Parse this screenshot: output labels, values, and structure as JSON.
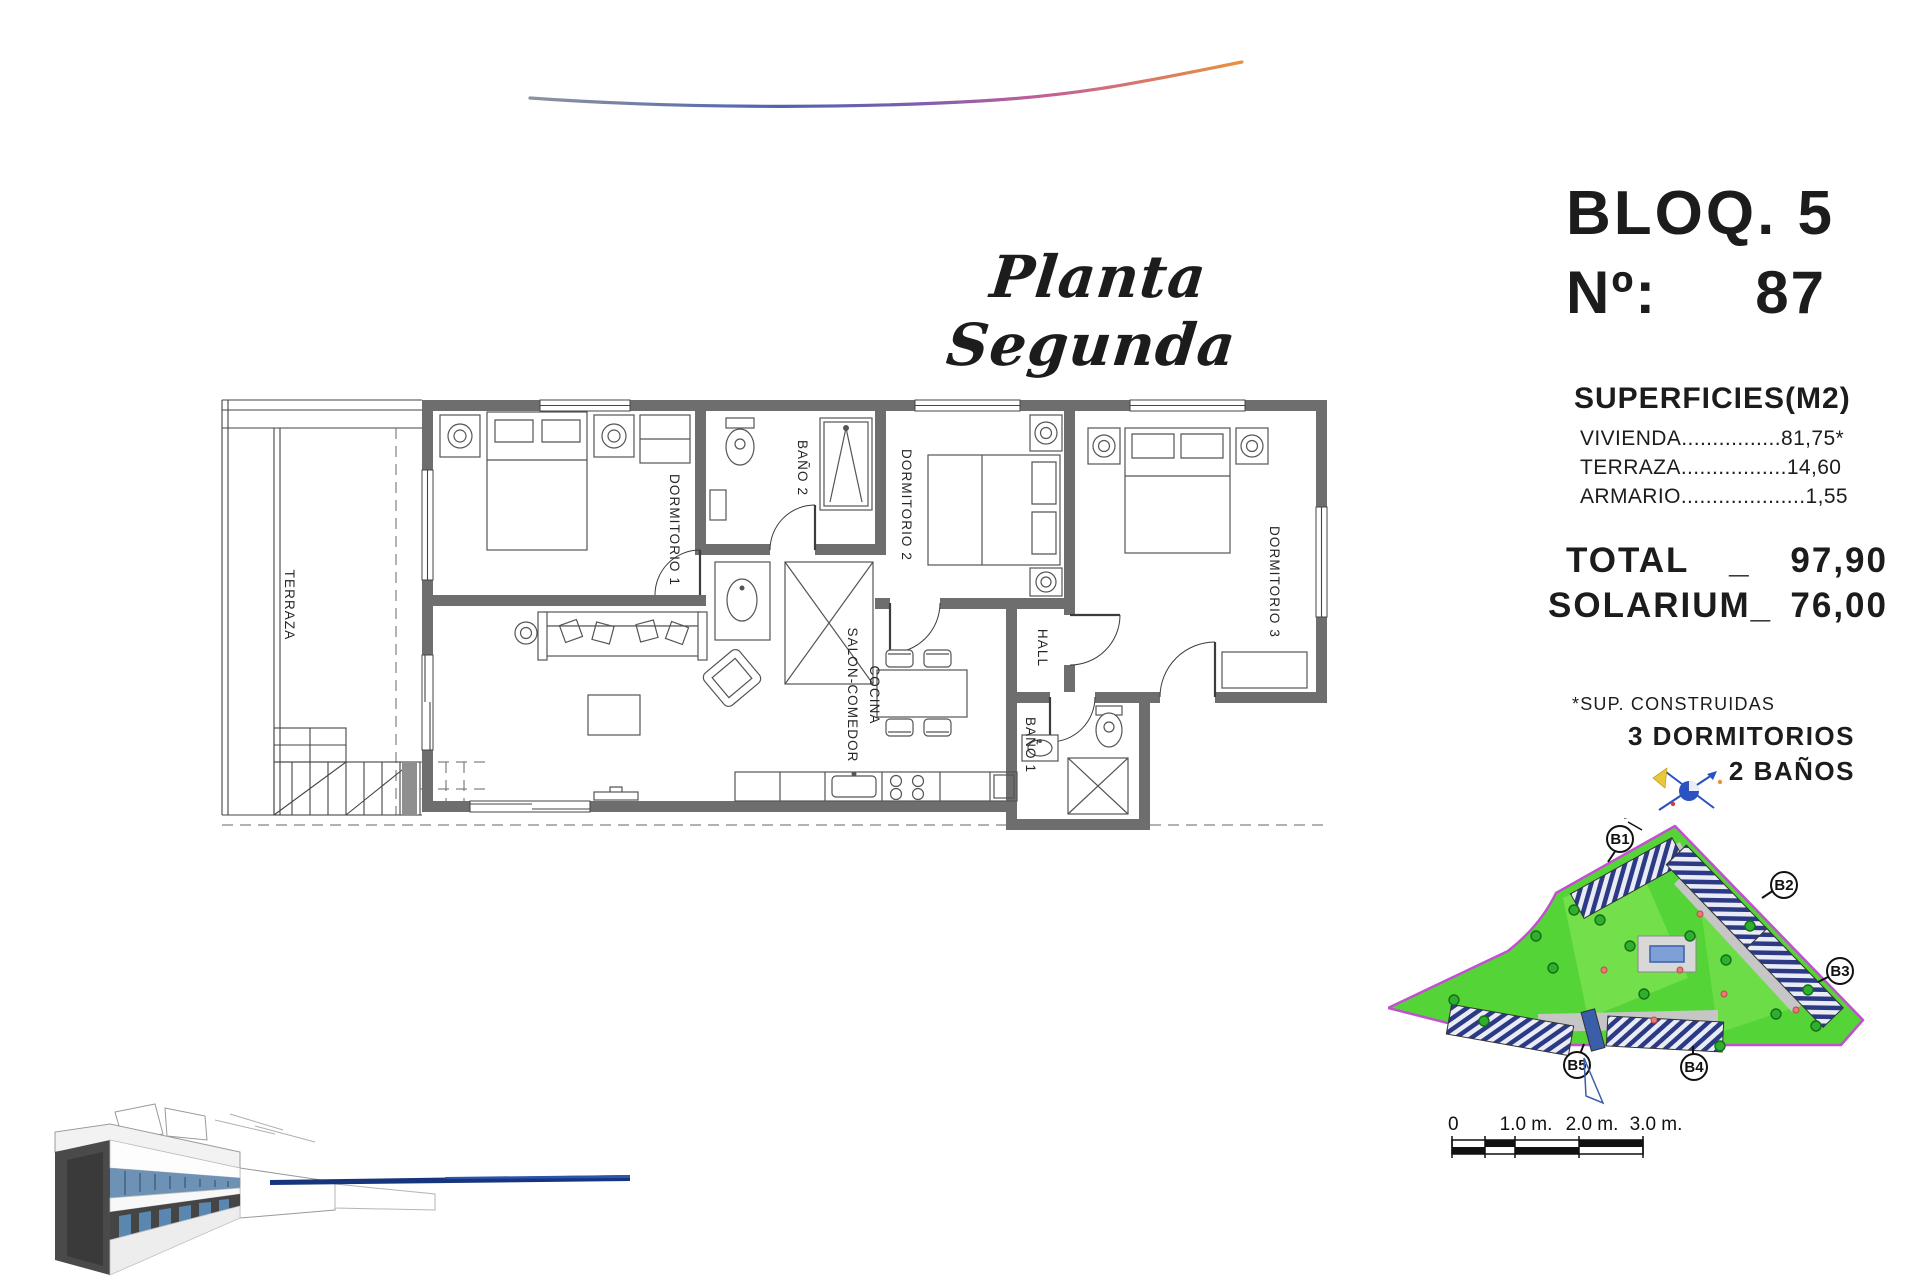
{
  "header": {
    "script_title": "Planta Segunda"
  },
  "info_panel": {
    "block": "BLOQ. 5",
    "unit_label": "Nº:",
    "unit_number": "87",
    "surfaces_title": "SUPERFICIES(M2)",
    "surfaces": [
      {
        "name": "VIVIENDA",
        "leader": "................",
        "value": "81,75*"
      },
      {
        "name": "TERRAZA",
        "leader": ".................",
        "value": "14,60"
      },
      {
        "name": "ARMARIO",
        "leader": "....................",
        "value": "1,55"
      }
    ],
    "total_label": "TOTAL",
    "total_sep": "_",
    "total_value": "97,90",
    "solarium_label": "SOLARIUM_",
    "solarium_value": "76,00",
    "footnote": "*SUP. CONSTRUIDAS",
    "program_bedrooms": "3 DORMITORIOS",
    "program_bathrooms": "2 BAÑOS"
  },
  "floor_plan": {
    "labels": {
      "terraza": "TERRAZA",
      "dormitorio1": "DORMITORIO 1",
      "bano2": "BAÑO 2",
      "dormitorio2": "DORMITORIO 2",
      "dormitorio3": "DORMITORIO 3",
      "hall": "HALL",
      "salon_line1": "SALON-COMEDOR",
      "salon_line2": "COCINA",
      "bano1": "BAÑO 1"
    },
    "wall_color": "#6e6e6e"
  },
  "site_plan": {
    "labels": [
      "B1",
      "B2",
      "B3",
      "B4",
      "B5"
    ],
    "ground_color": "#55d437",
    "boundary_color": "#c24fd0",
    "building_hatch_color": "#2c3a85",
    "pool_color": "#3a5fa8",
    "tree_color": "#2fae2f"
  },
  "scale_bar": {
    "labels": [
      "0",
      "1.0 m.",
      "2.0 m.",
      "3.0 m."
    ]
  },
  "decor": {
    "blue_line_color": "#16357d"
  }
}
